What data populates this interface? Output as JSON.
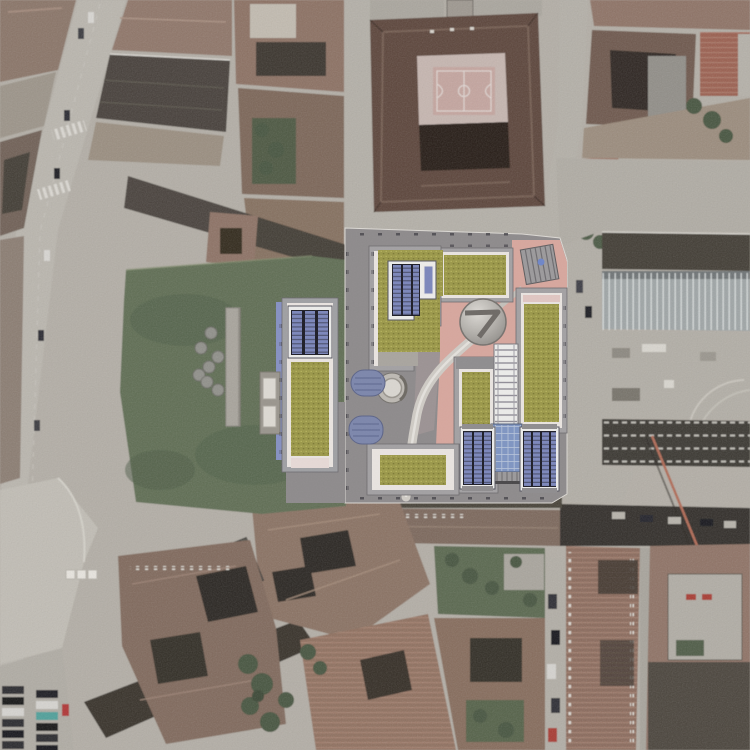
{
  "scene": {
    "kind": "aerial-satellite-photograph",
    "overlay": "architectural-masterplan-render",
    "character": "dense European city blocks with tiled roofs, central masterplan with green roofs, solar arrays and pink plaza",
    "canvas": {
      "width": 750,
      "height": 750
    }
  },
  "palette": {
    "base_pavement": "#b3aea6",
    "street_light": "#bab6ae",
    "street_shadow": "#332f29",
    "plan_shadow": "#474239",
    "roof_brown": "#8a7265",
    "roof_brown_light": "#9a8475",
    "roof_brown_dark": "#6e5a4e",
    "roof_maroon": "#5b443a",
    "roof_red": "#9a6a59",
    "dark_slab": "#423d36",
    "courtyard_dark": "#2e2922",
    "ribbed_metal_roof": "#9fa5a6",
    "park_green": "#5e6d53",
    "tree_green": "#47543f",
    "plan_plinth": "#8e8b8c",
    "plan_plaza_pink": "#d7a79e",
    "plan_walkway_mauve": "#9c9394",
    "plan_frame_gray": "#a3a1a3",
    "plan_frame_light": "#e9e4e0",
    "plan_roof_moss": "#9b984a",
    "solar_panel_blue": "#7c87bb",
    "solar_frame_dark": "#1d1d27",
    "glass_blue": "#7f95c2",
    "canopy_oval_blue": "#7d87ac",
    "path_light": "#cfcbc5",
    "dome_gray": "#b5b2ad",
    "courtyard_pink": "#c6b6b0",
    "sport_court_pink": "#c4a59f",
    "plaza_light": "#c1bdb5"
  },
  "masterplan": {
    "buildings": [
      {
        "id": "northwest-l-building",
        "roof": "moss-green",
        "solar_array_strips": 3
      },
      {
        "id": "north-garden-terrace",
        "roof": "moss-green"
      },
      {
        "id": "east-slab",
        "roof": "moss-green",
        "accent": "pink-band"
      },
      {
        "id": "center-south-slab",
        "roof": "moss-green"
      },
      {
        "id": "southwest-slab",
        "roof": "moss-green"
      },
      {
        "id": "south-solar-wing-left",
        "solar_array_strips": 3
      },
      {
        "id": "south-solar-wing-right",
        "solar_array_strips": 4
      },
      {
        "id": "glass-atrium-tower",
        "facade": "glass-grid"
      },
      {
        "id": "northeast-stair-pavilion",
        "roof": "ribbed",
        "marker": "blue-dot"
      },
      {
        "id": "round-pavilion",
        "roof": "circular-dome"
      },
      {
        "id": "west-park-slab",
        "roof": "moss-green",
        "solar_array_strips": 3
      }
    ],
    "blue_canopies": 2,
    "entry_rotunda": 1,
    "curved_promenade": true
  },
  "park": {
    "trees": 7,
    "footpath": "north-south strip"
  },
  "context": {
    "school_courtyard_sport_court": true,
    "parking_rows_southwest_cars": 12,
    "crosswalks_west_boulevard": 2
  }
}
